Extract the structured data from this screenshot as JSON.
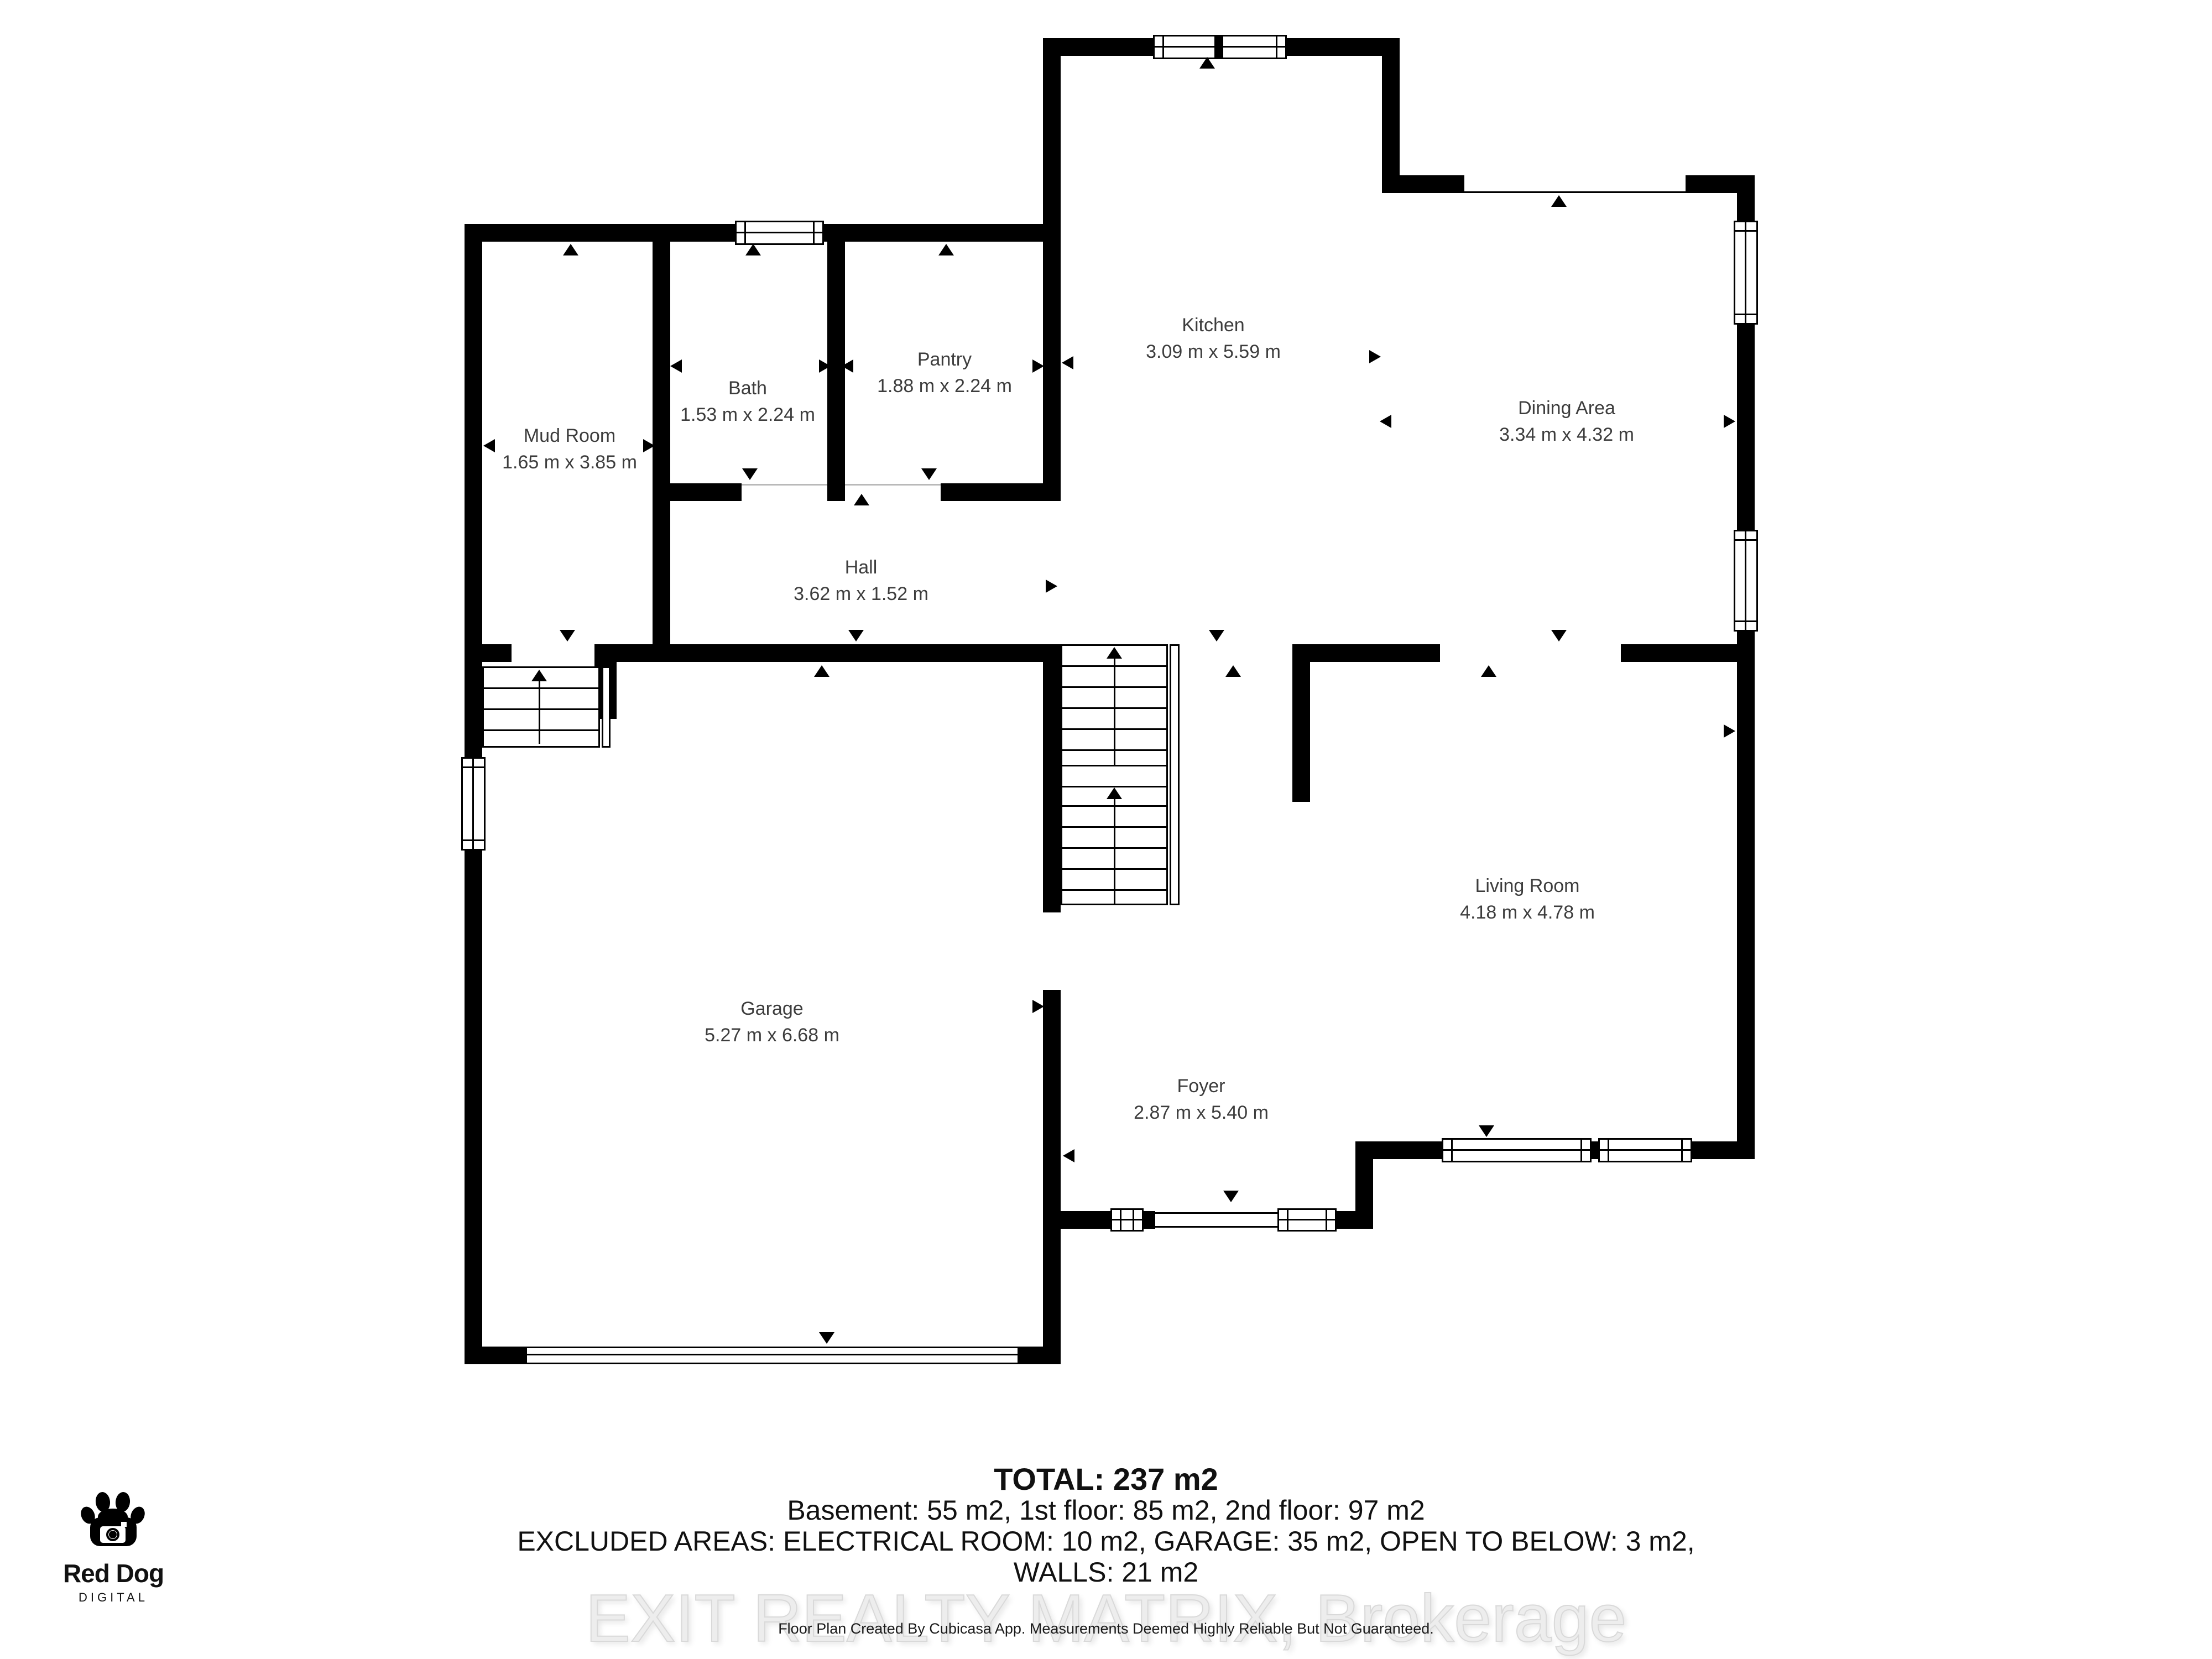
{
  "rooms": {
    "mud_room": {
      "name": "Mud Room",
      "dims": "1.65 m x 3.85 m"
    },
    "bath": {
      "name": "Bath",
      "dims": "1.53 m x 2.24 m"
    },
    "pantry": {
      "name": "Pantry",
      "dims": "1.88 m x 2.24 m"
    },
    "kitchen": {
      "name": "Kitchen",
      "dims": "3.09 m x 5.59 m"
    },
    "dining": {
      "name": "Dining Area",
      "dims": "3.34 m x 4.32 m"
    },
    "hall": {
      "name": "Hall",
      "dims": "3.62 m x 1.52 m"
    },
    "garage": {
      "name": "Garage",
      "dims": "5.27 m x 6.68 m"
    },
    "living": {
      "name": "Living Room",
      "dims": "4.18 m x 4.78 m"
    },
    "foyer": {
      "name": "Foyer",
      "dims": "2.87 m x 5.40 m"
    }
  },
  "summary": {
    "total": "TOTAL: 237 m2",
    "floors": "Basement: 55 m2, 1st floor: 85 m2, 2nd floor: 97 m2",
    "excluded": "EXCLUDED AREAS: ELECTRICAL ROOM: 10 m2, GARAGE: 35 m2, OPEN TO BELOW: 3 m2,",
    "walls": "WALLS: 21 m2"
  },
  "watermark": "EXIT REALTY MATRIX, Brokerage",
  "disclaimer": "Floor Plan Created By Cubicasa App. Measurements Deemed Highly Reliable But Not Guaranteed.",
  "logo": {
    "name": "Red Dog",
    "sub": "DIGITAL",
    "icon": "paw-camera-icon"
  },
  "colors": {
    "wall": "#000000",
    "room_label": "#3d3d3d",
    "summary_text": "#111111",
    "watermark": "#ededed"
  }
}
